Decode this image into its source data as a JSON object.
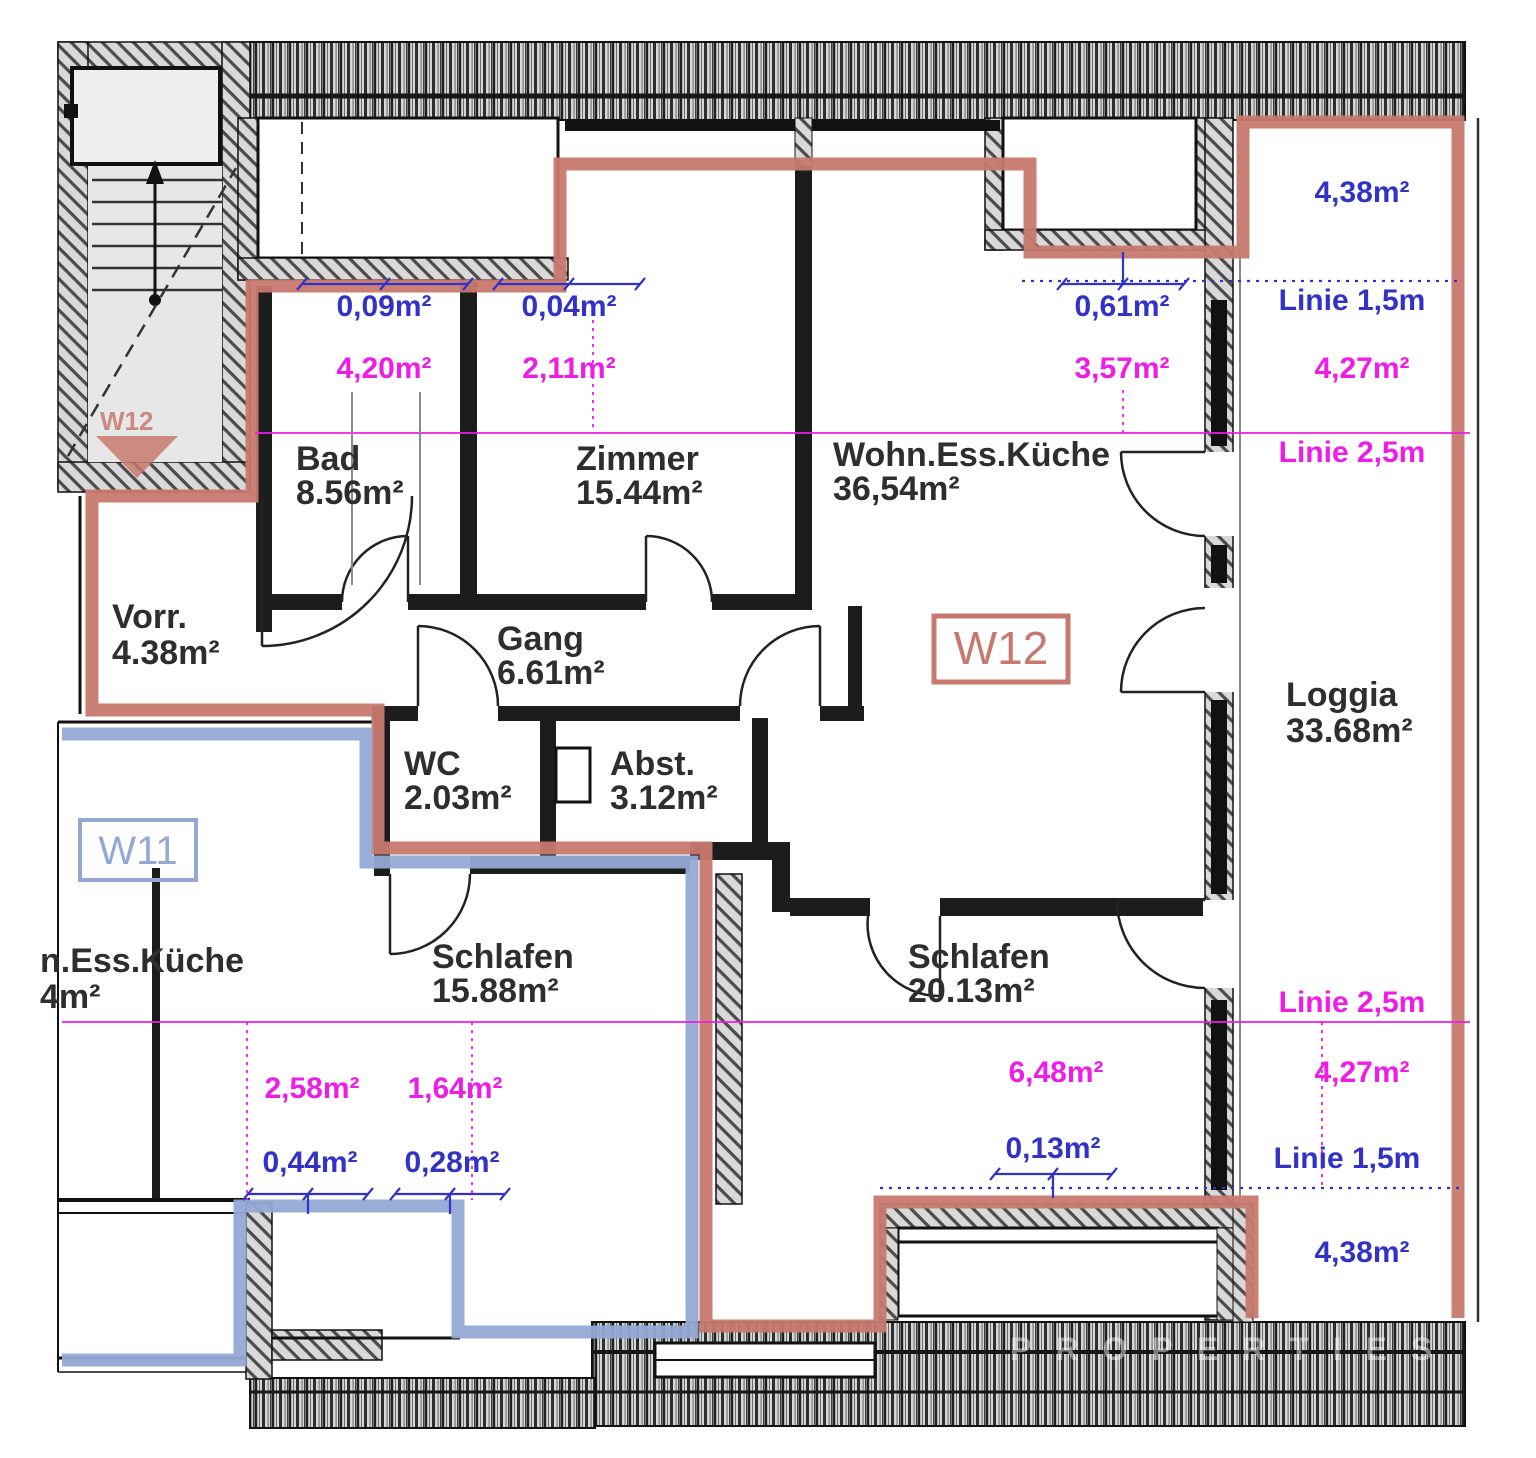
{
  "plan": {
    "colors": {
      "w12": "#c8796f",
      "w11": "#93a9d4",
      "dim_blue": "#3232c8",
      "dim_magenta": "#ee1ce6"
    },
    "apartments": {
      "w12_label": "W12",
      "w11_label": "W11",
      "w12_entry_label": "W12"
    },
    "rooms": [
      {
        "name": "Bad",
        "area": "8.56m²"
      },
      {
        "name": "Zimmer",
        "area": "15.44m²"
      },
      {
        "name": "Wohn.Ess.Küche",
        "area": "36,54m²"
      },
      {
        "name": "Vorr.",
        "area": "4.38m²"
      },
      {
        "name": "Gang",
        "area": "6.61m²"
      },
      {
        "name": "WC",
        "area": "2.03m²"
      },
      {
        "name": "Abst.",
        "area": "3.12m²"
      },
      {
        "name": "Schlafen",
        "area": "15.88m²"
      },
      {
        "name": "Schlafen",
        "area": "20.13m²"
      },
      {
        "name": "Loggia",
        "area": "33.68m²"
      }
    ],
    "partial_room": {
      "name_fragment": "n.Ess.Küche",
      "area_fragment": "4m²"
    },
    "dims_blue": [
      "0,09m²",
      "0,04m²",
      "0,61m²",
      "4,38m²",
      "Linie 1,5m",
      "0,44m²",
      "0,28m²",
      "0,13m²",
      "Linie 1,5m",
      "4,38m²"
    ],
    "dims_magenta": [
      "4,20m²",
      "2,11m²",
      "3,57m²",
      "4,27m²",
      "Linie 2,5m",
      "2,58m²",
      "1,64m²",
      "6,48m²",
      "4,27m²",
      "Linie 2,5m"
    ],
    "watermark": "PROPERTIES"
  }
}
